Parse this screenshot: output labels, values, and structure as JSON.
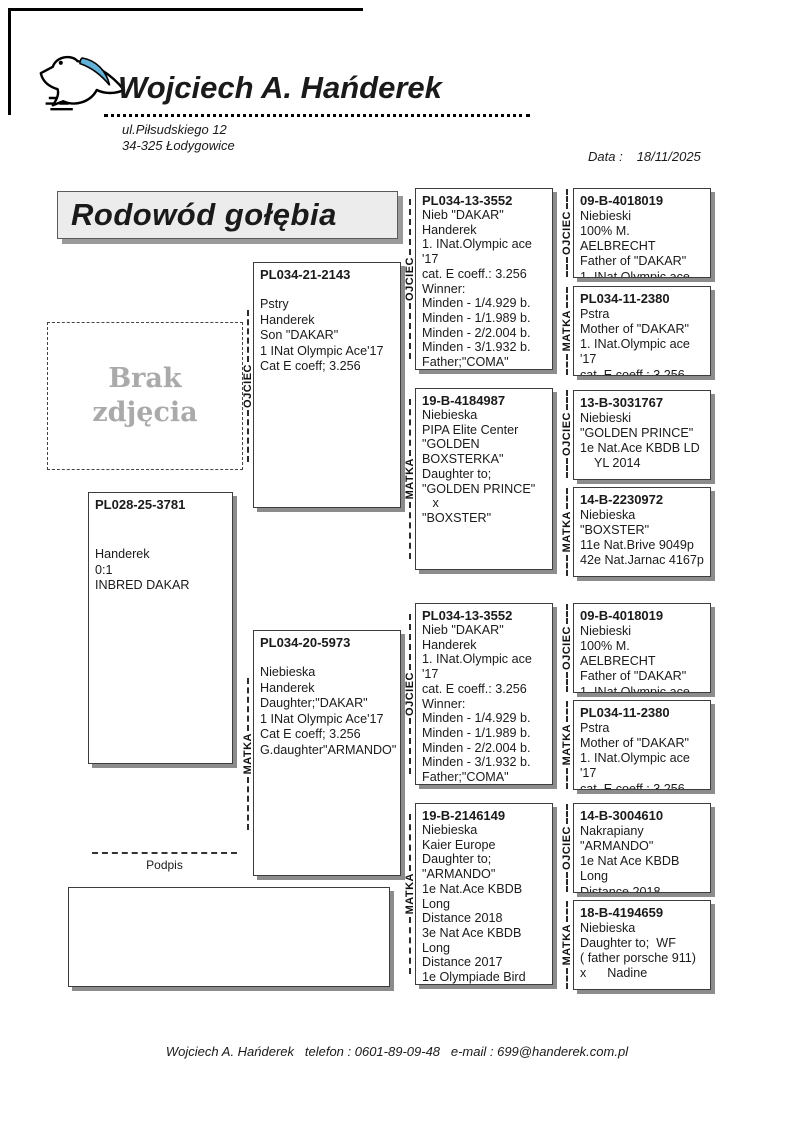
{
  "header": {
    "breeder_name": "Wojciech A. Hańderek",
    "address_line1": "ul.Piłsudskiego 12",
    "address_line2": "34-325 Łodygowice",
    "date_label": "Data :",
    "date_value": "18/11/2025"
  },
  "title": "Rodowód gołębia",
  "photo_placeholder": "Brak\nzdjęcia",
  "signature_label": "Podpis",
  "relation_labels": {
    "father": "OJCIEC",
    "mother": "MATKA"
  },
  "footer": "Wojciech A. Hańderek   telefon : 0601-89-09-48   e-mail : 699@handerek.com.pl",
  "pedigree": {
    "subject": {
      "ring": "PL028-25-3781",
      "details": "Handerek\n0:1\nINBRED DAKAR"
    },
    "father": {
      "ring": "PL034-21-2143",
      "details": "Pstry\nHanderek\nSon \"DAKAR\"\n1 INat Olympic Ace'17\nCat E coeff; 3.256"
    },
    "mother": {
      "ring": "PL034-20-5973",
      "details": "Niebieska\nHanderek\nDaughter;\"DAKAR\"\n1 INat Olympic Ace'17\nCat E coeff; 3.256\nG.daughter\"ARMANDO\""
    },
    "grandparents": [
      {
        "role": "father-of-father",
        "ring": "PL034-13-3552",
        "details": "Nieb \"DAKAR\"\nHanderek\n1. INat.Olympic ace '17\ncat. E coeff.: 3.256\nWinner:\nMinden - 1/4.929 b.\nMinden - 1/1.989 b.\nMinden - 2/2.004 b.\nMinden - 3/1.932 b.\nFather;\"COMA\"\n2 INat Olympic Ace'22"
      },
      {
        "role": "mother-of-father",
        "ring": "19-B-4184987",
        "details": "Niebieska\nPIPA Elite Center\n\"GOLDEN\nBOXSTERKA\"\nDaughter to;\n\"GOLDEN PRINCE\"\n   x\n\"BOXSTER\""
      },
      {
        "role": "father-of-mother",
        "ring": "PL034-13-3552",
        "details": "Nieb \"DAKAR\"\nHanderek\n1. INat.Olympic ace '17\ncat. E coeff.: 3.256\nWinner:\nMinden - 1/4.929 b.\nMinden - 1/1.989 b.\nMinden - 2/2.004 b.\nMinden - 3/1.932 b.\nFather;\"COMA\"\n2 INat Olympic Ace'22"
      },
      {
        "role": "mother-of-mother",
        "ring": "19-B-2146149",
        "details": "Niebieska\nKaier Europe\nDaughter to;\n\"ARMANDO\"\n1e Nat.Ace KBDB Long\nDistance 2018\n3e Nat Ace KBDB Long\nDistance 2017\n1e Olympiade Bird\nCat C Poland 2019\n1e Nat Angouleme\"18"
      }
    ],
    "great_grandparents": [
      {
        "ring": "09-B-4018019",
        "details": "Niebieski\n100% M. AELBRECHT\nFather of \"DAKAR\"\n1. INat.Olympic ace '17"
      },
      {
        "ring": "PL034-11-2380",
        "details": "Pstra\nMother of \"DAKAR\"\n1. INat.Olympic ace '17\ncat. E coeff.: 3.256"
      },
      {
        "ring": "13-B-3031767",
        "details": "Niebieski\n\"GOLDEN PRINCE\"\n1e Nat.Ace KBDB LD\n    YL 2014"
      },
      {
        "ring": "14-B-2230972",
        "details": "Niebieska\n\"BOXSTER\"\n11e Nat.Brive 9049p\n42e Nat.Jarnac 4167p"
      },
      {
        "ring": "09-B-4018019",
        "details": "Niebieski\n100% M. AELBRECHT\nFather of \"DAKAR\"\n1. INat.Olympic ace '17"
      },
      {
        "ring": "PL034-11-2380",
        "details": "Pstra\nMother of \"DAKAR\"\n1. INat.Olympic ace '17\ncat. E coeff.: 3.256"
      },
      {
        "ring": "14-B-3004610",
        "details": "Nakrapiany\n\"ARMANDO\"\n1e Nat Ace KBDB Long\nDistance 2018"
      },
      {
        "ring": "18-B-4194659",
        "details": "Niebieska\nDaughter to;  WF\n( father porsche 911)\nx      Nadine"
      }
    ]
  }
}
